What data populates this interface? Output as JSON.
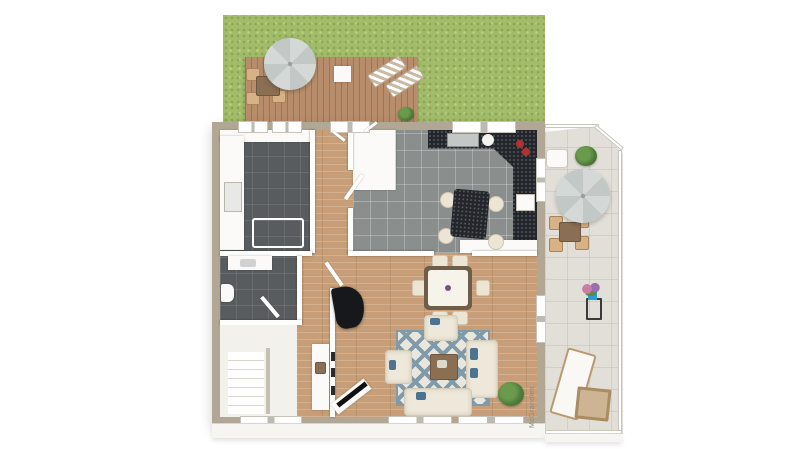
{
  "watermark": {
    "text": "McGrandles"
  },
  "palette": {
    "background": "#ffffff",
    "grass_green": "#a2bc6b",
    "deck_wood": "#b78d6c",
    "exterior_wall": "#b2a795",
    "wood_floor": "#c79e77",
    "dark_tile": "#585c5e",
    "kitchen_tile": "#8a8e8d",
    "counter_stone": "#23262b",
    "terrace_tile": "#e1dfd7",
    "sofa_cream": "#eee8da",
    "accent_blue": "#4c7390",
    "rug_pattern_blue": "#7f9aa8",
    "plant_green": "#4e7d3a",
    "umbrella_gray": "#c9cfcd"
  },
  "objects": [
    "garden-lawn",
    "wood-deck",
    "patio-umbrella",
    "outdoor-dining-set",
    "sun-loungers",
    "utility-room",
    "bathroom",
    "staircase",
    "entry-hall",
    "kitchen",
    "kitchen-island",
    "living-room",
    "grand-piano",
    "corner-sofa",
    "area-rug",
    "dining-table",
    "tv-corner",
    "side-terrace",
    "terrace-dining-set",
    "terrace-sun-lounger",
    "potted-plants"
  ]
}
